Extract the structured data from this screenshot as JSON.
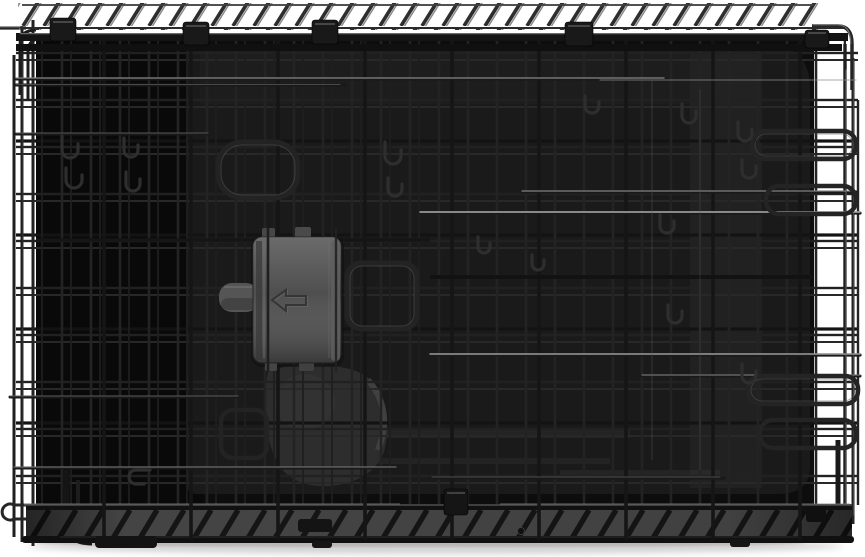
{
  "meta": {
    "type": "product-photo",
    "subject": "Folded black metal wire dog crate with gray plastic slide latch, dark floor tray and wire handle loops, photographed on a white background with a soft ground shadow"
  },
  "colors": {
    "background": "#ffffff",
    "wire": "#232323",
    "wire_deep": "#141414",
    "wire_sheen": "#9a9a9a",
    "interior": "#0d0d0d",
    "interior_left": "#090909",
    "tray": "#1a1a1a",
    "tray_sheen": "#262626",
    "latch_body": "#4f4f4f",
    "latch_tab": "#555555",
    "second_latch": "#2d2d2d",
    "hatch_bg": "#484848",
    "hatch_mark": "#161616",
    "shadow": "#c9c9c9"
  },
  "parts": {
    "top_edge": "folded-top-panel-serrated-edge",
    "grid": "wire-mesh-panels",
    "tray": "plastic-floor-tray",
    "latch": "plastic-slide-latch",
    "latch_arrow": "slide-direction-arrow-icon",
    "handles": "wire-door-handle-loops",
    "hooks": "wire-latch-hooks",
    "bottom_edge": "folded-bottom-panel-serrated-edge",
    "shadow": "ground-shadow"
  }
}
